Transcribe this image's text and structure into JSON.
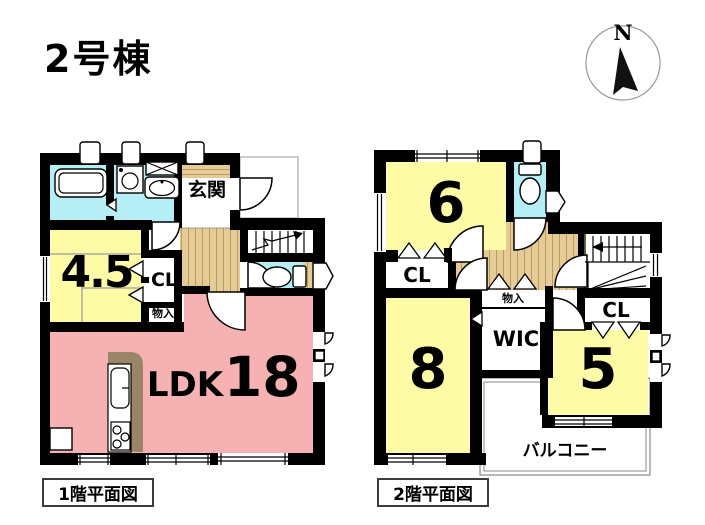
{
  "title": "2号棟",
  "compass": {
    "label": "N"
  },
  "floor1": {
    "caption": "1階平面図",
    "entrance": "玄関",
    "tatami_size": "4.5",
    "closet": "CL",
    "storage": "物入",
    "ldk_label": "LDK",
    "ldk_size": "18"
  },
  "floor2": {
    "caption": "2階平面図",
    "room6": "6",
    "closet_a": "CL",
    "room8": "8",
    "storage": "物入",
    "wic": "WIC",
    "closet_b": "CL",
    "room5": "5",
    "balcony": "バルコニー"
  },
  "colors": {
    "wall": "#000000",
    "water_room": "#b5eef5",
    "room_yellow": "#fdfba6",
    "ldk_pink": "#f6b2b2",
    "floor_beige": "#e5cb96",
    "counter_brown": "#9b8568"
  }
}
